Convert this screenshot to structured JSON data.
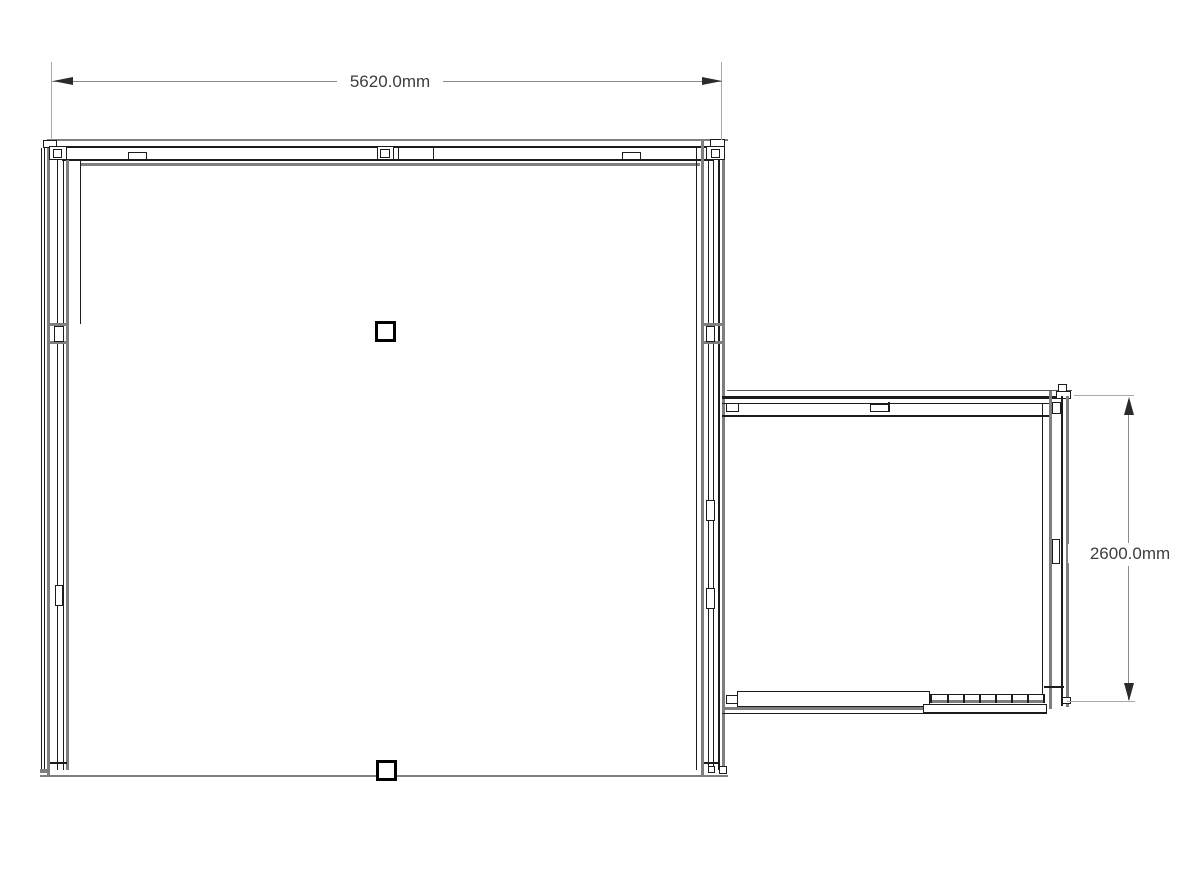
{
  "drawing": {
    "type": "floor-plan",
    "annotations": {
      "width_dimension": "5620.0mm",
      "height_dimension": "2600.0mm"
    },
    "rooms": [
      {
        "name": "main-room",
        "labeled_width_mm": 5620.0
      },
      {
        "name": "side-room",
        "labeled_height_mm": 2600.0
      }
    ],
    "columns_count": 2,
    "colors": {
      "background": "#ffffff",
      "wall_line_gray": "#7f7f7f",
      "wall_line_dark": "#1c1c1c",
      "dimension_line": "#8a8a8a",
      "dimension_text": "#3d3d3d",
      "column_border": "#000000",
      "column_fill": "#ffffff"
    }
  }
}
